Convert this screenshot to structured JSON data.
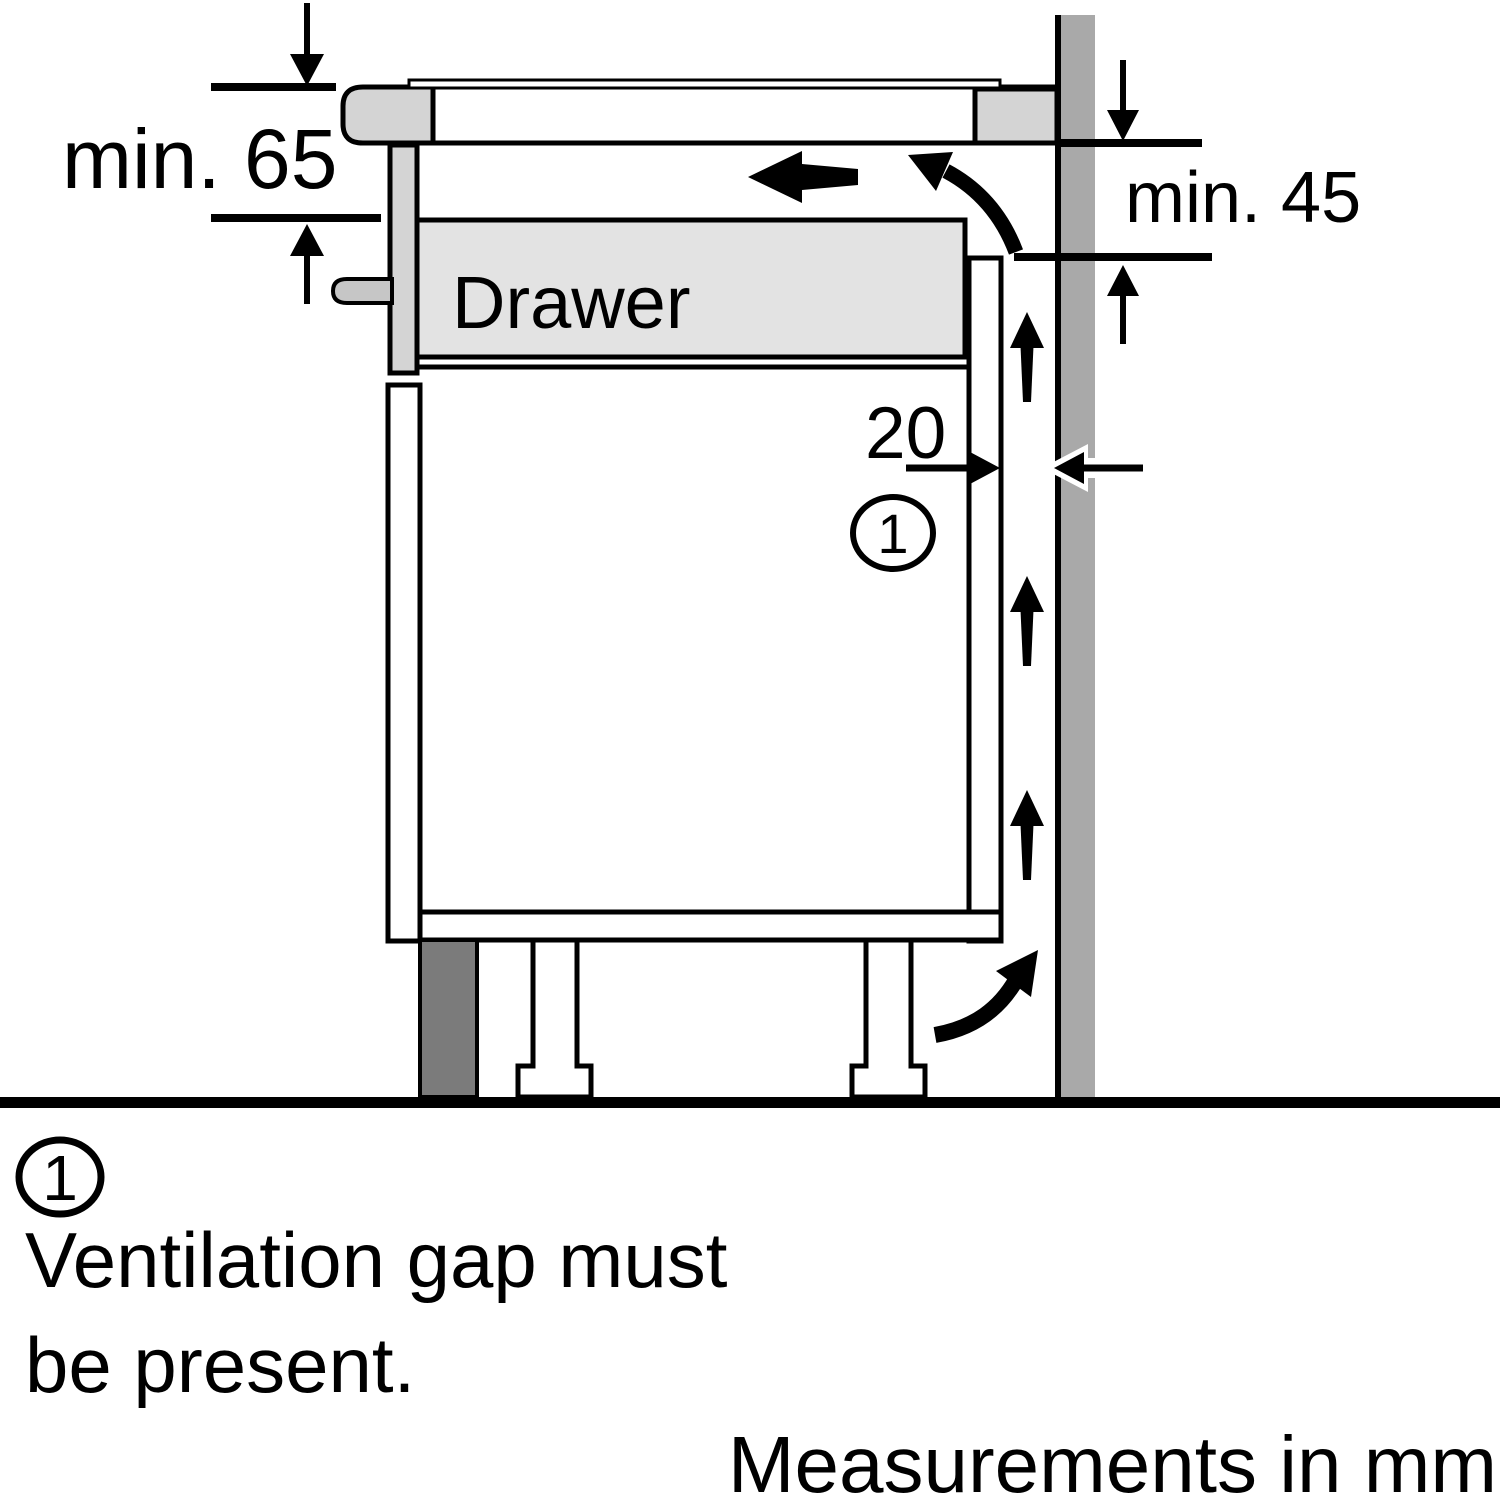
{
  "diagram": {
    "drawer_label": "Drawer",
    "dim_top_left": "min. 65",
    "dim_top_right": "min. 45",
    "dim_gap": "20",
    "callout": "1"
  },
  "legend": {
    "marker": "1",
    "line1": "Ventilation gap must",
    "line2": "be present."
  },
  "footer": {
    "units_note": "Measurements in mm"
  },
  "colors": {
    "outline": "#000000",
    "background": "#ffffff",
    "wall": "#a9a9a9",
    "plinth": "#7b7b7b",
    "light_panel": "#d4d4d4",
    "drawer_fill": "#e3e3e3",
    "handle": "#c6c6c6"
  }
}
